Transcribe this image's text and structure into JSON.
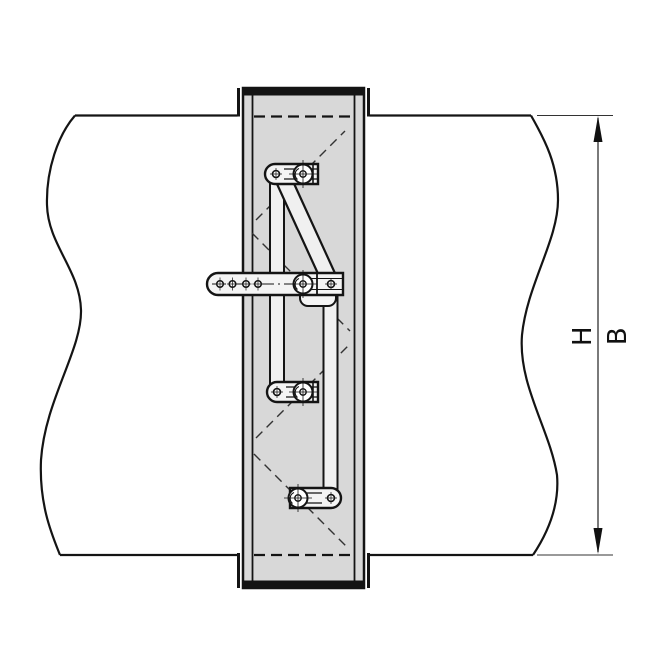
{
  "figure": {
    "type": "technical-drawing",
    "dimension_labels": {
      "h": "H",
      "b": "B"
    },
    "colors": {
      "background": "#ffffff",
      "frame_fill": "#d8d8d8",
      "link_fill": "#f0f0f0",
      "bracket_fill": "#f4f4f4",
      "outline": "#141414",
      "dimension": "#333333"
    }
  }
}
